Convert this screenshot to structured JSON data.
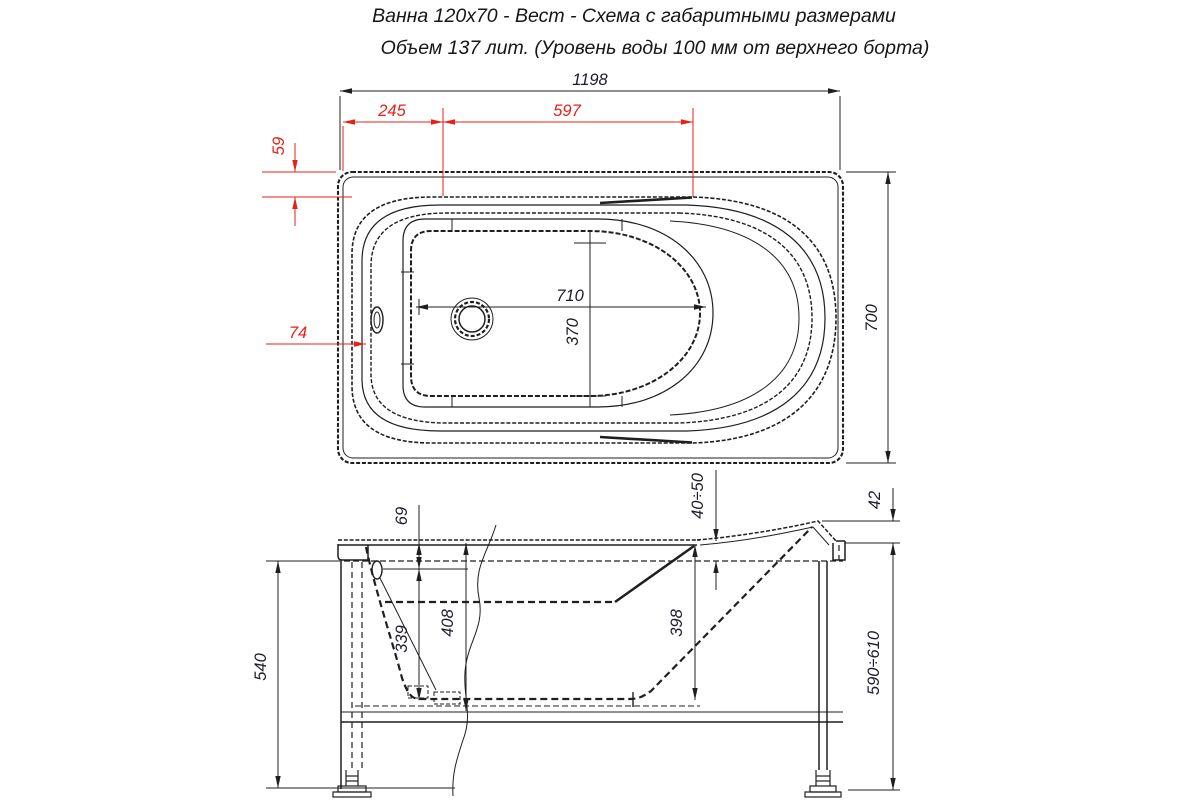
{
  "title": {
    "line1": "Ванна 120х70 - Вест - Схема с габаритными размерами",
    "line2": "Объем 137 лит. (Уровень воды 100 мм от верхнего борта)"
  },
  "colors": {
    "line": "#1f1f1f",
    "dimension_text": "#1c1c2b",
    "dimension_red": "#e32219",
    "background": "#ffffff"
  },
  "top_view": {
    "dims": {
      "overall_length": "1198",
      "edge_to_drain_zone": "245",
      "drain_zone_length": "597",
      "rim_width_top": "59",
      "rim_width_side": "74",
      "basin_length": "710",
      "basin_width": "370",
      "overall_width": "700"
    }
  },
  "side_view": {
    "dims": {
      "rim_to_overflow": "69",
      "overflow_to_bottom": "339",
      "shell_depth": "408",
      "inner_depth_back": "398",
      "apron_height": "540",
      "rim_clearance": "40÷50",
      "headrest_rise": "42",
      "installed_height": "590÷610"
    }
  }
}
